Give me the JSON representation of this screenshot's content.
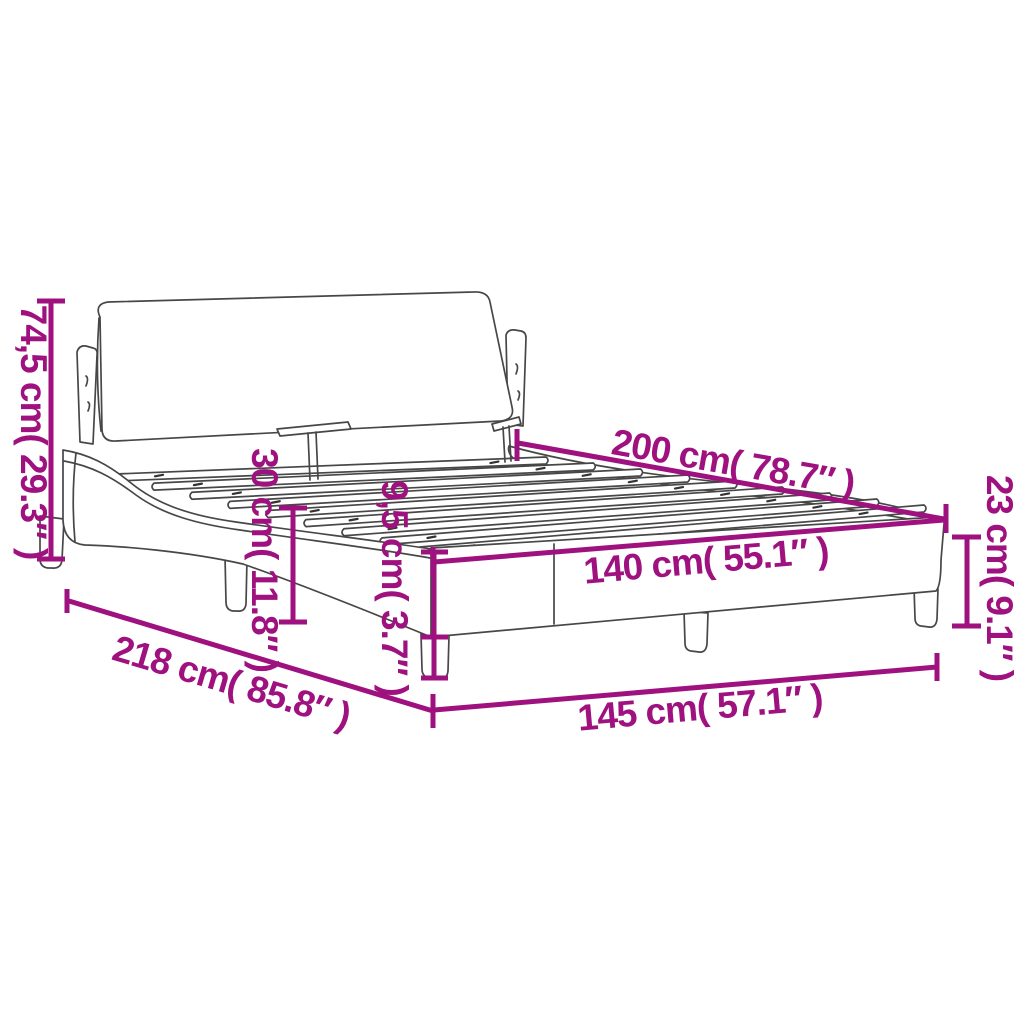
{
  "diagram": {
    "accent_color": "#9E117F",
    "ink_color": "#474747",
    "background": "#ffffff",
    "labels": {
      "headboard_height": "74,5 cm( 29.3″ )",
      "slat_top_height": "30 cm( 11.8″ )",
      "leg_height": "9,5 cm( 3.7″ )",
      "inner_length": "200 cm( 78.7″ )",
      "frame_height": "23 cm( 9.1″ )",
      "inner_width": "140 cm( 55.1″ )",
      "outer_width": "145 cm( 57.1″ )",
      "outer_length": "218 cm( 85.8″ )"
    }
  }
}
